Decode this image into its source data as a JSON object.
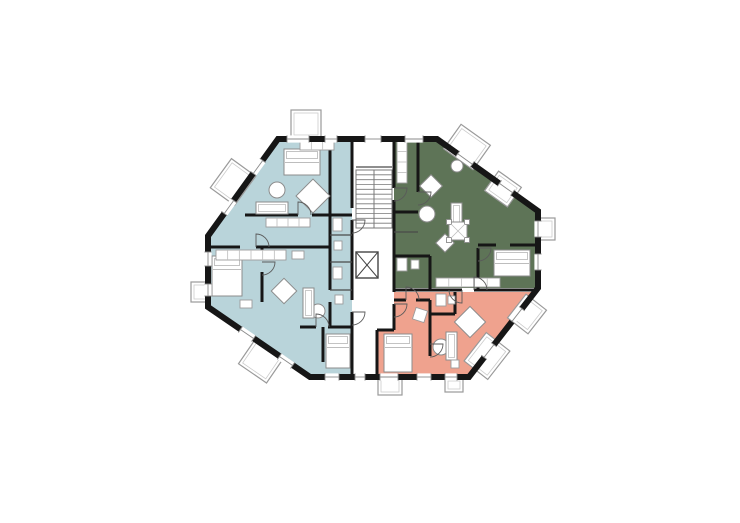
{
  "canvas": {
    "width": 740,
    "height": 523,
    "background": "#ffffff"
  },
  "palette": {
    "wall": "#161616",
    "blue": "#b9d4da",
    "green": "#5e7457",
    "salmon": "#efa28e",
    "furniture_stroke": "#8c8c8c",
    "furniture_light": "#bdbdbd",
    "balcony_stroke": "#9a9a9a",
    "balcony_inner": "#cccccc",
    "stair_stroke": "#787878",
    "door_stroke": "#5a5a5a",
    "window_line": "#8a8a8a",
    "thin_wall": "#4a4a4a",
    "white": "#ffffff"
  },
  "plan": {
    "outline": [
      [
        278,
        139
      ],
      [
        437,
        139
      ],
      [
        538,
        211
      ],
      [
        538,
        288
      ],
      [
        469,
        377
      ],
      [
        310,
        377
      ],
      [
        208,
        307
      ],
      [
        208,
        236
      ]
    ],
    "regions": [
      {
        "name": "apartment-west-blue",
        "color": "blue",
        "points": [
          [
            278,
            139
          ],
          [
            352,
            139
          ],
          [
            352,
            377
          ],
          [
            310,
            377
          ],
          [
            208,
            307
          ],
          [
            208,
            236
          ]
        ]
      },
      {
        "name": "apartment-northeast-green",
        "color": "green",
        "points": [
          [
            394,
            139
          ],
          [
            437,
            139
          ],
          [
            538,
            211
          ],
          [
            538,
            288
          ],
          [
            394,
            288
          ]
        ]
      },
      {
        "name": "apartment-southeast-salmon",
        "color": "salmon",
        "points": [
          [
            394,
            292
          ],
          [
            536,
            292
          ],
          [
            468,
            377
          ],
          [
            377,
            377
          ],
          [
            377,
            330
          ],
          [
            394,
            330
          ]
        ]
      }
    ],
    "core": {
      "x": 352,
      "y": 139,
      "w": 42,
      "h": 191
    },
    "stair": {
      "x": 356,
      "y": 170,
      "w": 36,
      "h": 58,
      "treads": 12
    },
    "elevator": {
      "x": 356,
      "y": 252,
      "w": 22,
      "h": 26
    },
    "interior_walls": [
      [
        352,
        139,
        352,
        208
      ],
      [
        352,
        220,
        352,
        300
      ],
      [
        352,
        312,
        352,
        377
      ],
      [
        394,
        139,
        394,
        188
      ],
      [
        394,
        200,
        394,
        292
      ],
      [
        394,
        304,
        394,
        330
      ],
      [
        377,
        330,
        394,
        330
      ],
      [
        377,
        330,
        377,
        377
      ],
      [
        330,
        139,
        330,
        290
      ],
      [
        330,
        302,
        330,
        327
      ],
      [
        245,
        215,
        298,
        215
      ],
      [
        312,
        215,
        352,
        215
      ],
      [
        208,
        247,
        240,
        247
      ],
      [
        256,
        247,
        330,
        247
      ],
      [
        262,
        247,
        262,
        258
      ],
      [
        262,
        272,
        262,
        302
      ],
      [
        300,
        327,
        316,
        327
      ],
      [
        328,
        327,
        352,
        327
      ],
      [
        323,
        327,
        323,
        362
      ],
      [
        418,
        139,
        418,
        192
      ],
      [
        394,
        212,
        418,
        212
      ],
      [
        478,
        248,
        478,
        290
      ],
      [
        478,
        245,
        496,
        245
      ],
      [
        510,
        245,
        538,
        245
      ],
      [
        394,
        256,
        430,
        256
      ],
      [
        430,
        256,
        430,
        290
      ],
      [
        394,
        290,
        462,
        290
      ],
      [
        474,
        290,
        538,
        290
      ],
      [
        430,
        300,
        430,
        356
      ],
      [
        394,
        300,
        406,
        300
      ],
      [
        416,
        300,
        430,
        300
      ],
      [
        455,
        292,
        455,
        314
      ],
      [
        430,
        314,
        455,
        314
      ]
    ],
    "thin_walls": [
      [
        330,
        235,
        352,
        235
      ],
      [
        330,
        262,
        352,
        262
      ],
      [
        330,
        290,
        352,
        290
      ],
      [
        356,
        167,
        392,
        167
      ],
      [
        394,
        232,
        418,
        232
      ]
    ],
    "balconies": [
      {
        "cx": 306,
        "cy": 124,
        "w": 30,
        "h": 28,
        "rot": 0
      },
      {
        "cx": 467,
        "cy": 147,
        "w": 36,
        "h": 30,
        "rot": 35.5
      },
      {
        "cx": 503,
        "cy": 189,
        "w": 28,
        "h": 24,
        "rot": 35.5
      },
      {
        "cx": 546,
        "cy": 229,
        "w": 18,
        "h": 22,
        "rot": 0
      },
      {
        "cx": 527,
        "cy": 314,
        "w": 30,
        "h": 26,
        "rot": -52
      },
      {
        "cx": 487,
        "cy": 356,
        "w": 36,
        "h": 30,
        "rot": -52
      },
      {
        "cx": 390,
        "cy": 386,
        "w": 24,
        "h": 18,
        "rot": 0
      },
      {
        "cx": 454,
        "cy": 385,
        "w": 18,
        "h": 14,
        "rot": 0
      },
      {
        "cx": 261,
        "cy": 361,
        "w": 34,
        "h": 30,
        "rot": 34.5
      },
      {
        "cx": 200,
        "cy": 292,
        "w": 18,
        "h": 20,
        "rot": 0
      },
      {
        "cx": 233,
        "cy": 182,
        "w": 36,
        "h": 30,
        "rot": -54
      }
    ],
    "windows": [
      {
        "x": 298,
        "y": 139,
        "len": 22,
        "rot": 0
      },
      {
        "x": 331,
        "y": 139,
        "len": 12,
        "rot": 0
      },
      {
        "x": 373,
        "y": 139,
        "len": 16,
        "rot": 0
      },
      {
        "x": 414,
        "y": 139,
        "len": 18,
        "rot": 0
      },
      {
        "x": 465,
        "y": 159,
        "len": 18,
        "rot": 35.5
      },
      {
        "x": 506,
        "y": 188,
        "len": 16,
        "rot": 35.5
      },
      {
        "x": 538,
        "y": 229,
        "len": 16,
        "rot": 90
      },
      {
        "x": 538,
        "y": 262,
        "len": 16,
        "rot": 90
      },
      {
        "x": 517,
        "y": 315,
        "len": 16,
        "rot": 128
      },
      {
        "x": 489,
        "y": 351,
        "len": 16,
        "rot": 128
      },
      {
        "x": 332,
        "y": 377,
        "len": 14,
        "rot": 0
      },
      {
        "x": 360,
        "y": 377,
        "len": 10,
        "rot": 0
      },
      {
        "x": 389,
        "y": 377,
        "len": 18,
        "rot": 0
      },
      {
        "x": 424,
        "y": 377,
        "len": 14,
        "rot": 0
      },
      {
        "x": 451,
        "y": 377,
        "len": 12,
        "rot": 0
      },
      {
        "x": 247,
        "y": 334,
        "len": 16,
        "rot": 34.5
      },
      {
        "x": 286,
        "y": 361,
        "len": 16,
        "rot": 34.5
      },
      {
        "x": 208,
        "y": 259,
        "len": 14,
        "rot": 90
      },
      {
        "x": 208,
        "y": 290,
        "len": 12,
        "rot": 90
      },
      {
        "x": 229,
        "y": 207,
        "len": 16,
        "rot": -54
      },
      {
        "x": 258,
        "y": 167,
        "len": 16,
        "rot": -54
      }
    ],
    "furniture": {
      "beds": [
        {
          "x": 284,
          "y": 149,
          "w": 36,
          "h": 26
        },
        {
          "x": 212,
          "y": 256,
          "w": 30,
          "h": 40
        },
        {
          "x": 326,
          "y": 334,
          "w": 24,
          "h": 34
        },
        {
          "x": 494,
          "y": 250,
          "w": 36,
          "h": 26
        },
        {
          "x": 384,
          "y": 334,
          "w": 28,
          "h": 38
        }
      ],
      "diamonds": [
        {
          "cx": 313,
          "cy": 196,
          "s": 24
        },
        {
          "cx": 284,
          "cy": 291,
          "s": 18
        },
        {
          "cx": 431,
          "cy": 186,
          "s": 16
        },
        {
          "cx": 445,
          "cy": 243,
          "s": 13
        },
        {
          "cx": 470,
          "cy": 322,
          "s": 22
        }
      ],
      "rounds": [
        {
          "cx": 277,
          "cy": 190,
          "r": 8
        },
        {
          "cx": 318,
          "cy": 311,
          "r": 7
        },
        {
          "cx": 427,
          "cy": 214,
          "r": 8
        },
        {
          "cx": 441,
          "cy": 347,
          "r": 8
        },
        {
          "cx": 457,
          "cy": 166,
          "r": 6
        }
      ],
      "sofas": [
        {
          "x": 256,
          "y": 202,
          "w": 32,
          "h": 12
        },
        {
          "x": 303,
          "y": 288,
          "w": 11,
          "h": 30
        },
        {
          "x": 451,
          "y": 203,
          "w": 11,
          "h": 28
        },
        {
          "x": 446,
          "y": 332,
          "w": 11,
          "h": 28
        }
      ],
      "counters": [
        {
          "x": 216,
          "y": 250,
          "w": 70,
          "h": 10,
          "ticks": 6
        },
        {
          "x": 266,
          "y": 218,
          "w": 44,
          "h": 9,
          "ticks": 4
        },
        {
          "x": 436,
          "y": 278,
          "w": 64,
          "h": 9,
          "ticks": 5
        },
        {
          "x": 397,
          "y": 141,
          "w": 10,
          "h": 42,
          "ticks": 4
        },
        {
          "x": 300,
          "y": 141,
          "w": 34,
          "h": 9,
          "ticks": 3
        }
      ],
      "ornate_tables": [
        {
          "cx": 458,
          "cy": 231,
          "s": 18
        }
      ],
      "misc": [
        {
          "x": 333,
          "y": 218,
          "w": 9,
          "h": 13,
          "rot": 0
        },
        {
          "x": 334,
          "y": 241,
          "w": 8,
          "h": 9,
          "rot": 0
        },
        {
          "x": 333,
          "y": 267,
          "w": 9,
          "h": 12,
          "rot": 0
        },
        {
          "x": 335,
          "y": 295,
          "w": 8,
          "h": 9,
          "rot": 0
        },
        {
          "x": 397,
          "y": 258,
          "w": 10,
          "h": 13,
          "rot": 0
        },
        {
          "x": 411,
          "y": 260,
          "w": 8,
          "h": 9,
          "rot": 0
        },
        {
          "x": 436,
          "y": 294,
          "w": 10,
          "h": 12,
          "rot": 0
        },
        {
          "x": 448,
          "y": 296,
          "w": 7,
          "h": 8,
          "rot": 0
        },
        {
          "x": 414,
          "y": 309,
          "w": 12,
          "h": 12,
          "rot": 18
        },
        {
          "x": 240,
          "y": 300,
          "w": 12,
          "h": 8,
          "rot": 0
        },
        {
          "x": 451,
          "y": 360,
          "w": 8,
          "h": 8,
          "rot": 0
        },
        {
          "x": 292,
          "y": 251,
          "w": 12,
          "h": 8,
          "rot": 0
        }
      ]
    },
    "doors": [
      {
        "x": 298,
        "y": 215,
        "rot": 0
      },
      {
        "x": 256,
        "y": 247,
        "rot": 0
      },
      {
        "x": 262,
        "y": 262,
        "rot": 90
      },
      {
        "x": 316,
        "y": 327,
        "rot": 0
      },
      {
        "x": 352,
        "y": 220,
        "rot": 90
      },
      {
        "x": 394,
        "y": 188,
        "rot": 90
      },
      {
        "x": 394,
        "y": 304,
        "rot": 90
      },
      {
        "x": 430,
        "y": 344,
        "rot": 90
      },
      {
        "x": 478,
        "y": 248,
        "rot": 90
      },
      {
        "x": 406,
        "y": 300,
        "rot": 0
      },
      {
        "x": 352,
        "y": 312,
        "rot": 90
      },
      {
        "x": 418,
        "y": 192,
        "rot": 90
      },
      {
        "x": 474,
        "y": 290,
        "rot": 0
      },
      {
        "x": 462,
        "y": 290,
        "rot": 180
      }
    ]
  }
}
